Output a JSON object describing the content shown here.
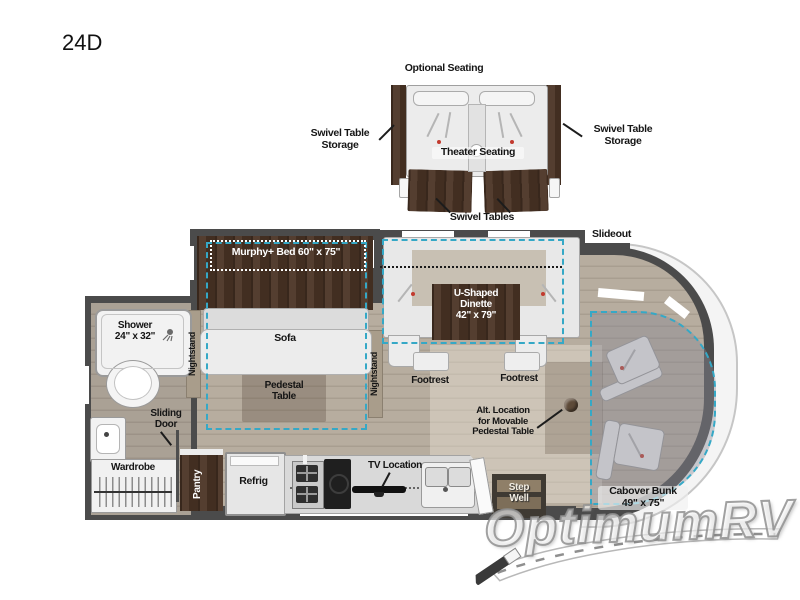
{
  "plan": {
    "code": "24D"
  },
  "brand": {
    "watermark": "OptimumRV"
  },
  "colors": {
    "wall": "#4b4b4b",
    "floor_wood": "#b0a698",
    "cabinet_wood": "#4b3425",
    "furniture_white": "#ececec",
    "slideout_accent": "#35a8c6",
    "label_text": "#151515"
  },
  "inset": {
    "optional_seating": "Optional Seating",
    "theater_seating": "Theater Seating",
    "swivel_tables": "Swivel Tables",
    "swivel_storage_left": "Swivel Table\nStorage",
    "swivel_storage_right": "Swivel Table\nStorage"
  },
  "rooms": {
    "slideout": "Slideout",
    "murphy_bed": "Murphy+ Bed 60\" x 75\"",
    "sofa": "Sofa",
    "nightstand_left": "Nightstand",
    "nightstand_right": "Nightstand",
    "pedestal_table": "Pedestal\nTable",
    "u_dinette": "U-Shaped\nDinette\n42\" x 79\"",
    "footrest_left": "Footrest",
    "footrest_right": "Footrest",
    "alt_location": "Alt. Location\nfor Movable\nPedestal Table",
    "shower": "Shower\n24\" x 32\"",
    "sliding_door": "Sliding\nDoor",
    "wardrobe": "Wardrobe",
    "pantry": "Pantry",
    "refrig": "Refrig",
    "tv_location": "TV Location",
    "step_well": "Step\nWell",
    "cabover_bunk": "Cabover Bunk\n49\" x 75\""
  }
}
